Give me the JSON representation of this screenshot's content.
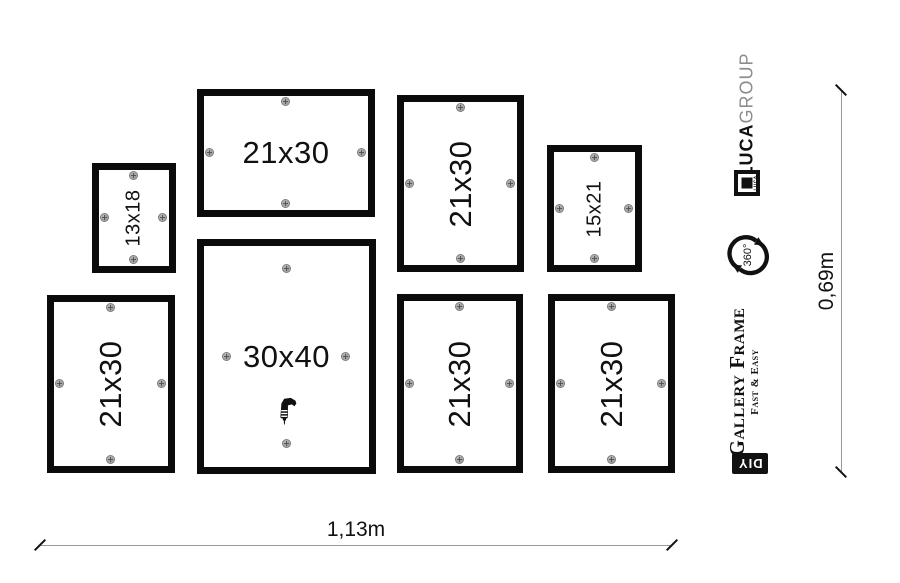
{
  "frames": [
    {
      "id": "frame-13x18-top-left",
      "label": "13x18",
      "x": 92,
      "y": 163,
      "w": 84,
      "h": 110,
      "rotated": true,
      "size": "small",
      "screw_inset": 13,
      "has_drill": false
    },
    {
      "id": "frame-21x30-top-center",
      "label": "21x30",
      "x": 197,
      "y": 89,
      "w": 178,
      "h": 128,
      "rotated": false,
      "size": "large",
      "screw_inset": 13,
      "has_drill": false
    },
    {
      "id": "frame-21x30-top-right",
      "label": "21x30",
      "x": 397,
      "y": 95,
      "w": 127,
      "h": 177,
      "rotated": true,
      "size": "large",
      "screw_inset": 13,
      "has_drill": false
    },
    {
      "id": "frame-15x21-top-far-right",
      "label": "15x21",
      "x": 547,
      "y": 145,
      "w": 95,
      "h": 127,
      "rotated": true,
      "size": "small",
      "screw_inset": 13,
      "has_drill": false
    },
    {
      "id": "frame-21x30-bottom-left",
      "label": "21x30",
      "x": 47,
      "y": 295,
      "w": 128,
      "h": 178,
      "rotated": true,
      "size": "large",
      "screw_inset": 13,
      "has_drill": false
    },
    {
      "id": "frame-30x40-center",
      "label": "30x40",
      "x": 197,
      "y": 239,
      "w": 179,
      "h": 235,
      "rotated": false,
      "size": "large",
      "screw_inset": 30,
      "has_drill": true
    },
    {
      "id": "frame-21x30-bottom-middle",
      "label": "21x30",
      "x": 397,
      "y": 294,
      "w": 126,
      "h": 179,
      "rotated": true,
      "size": "large",
      "screw_inset": 13,
      "has_drill": false
    },
    {
      "id": "frame-21x30-bottom-right",
      "label": "21x30",
      "x": 548,
      "y": 294,
      "w": 127,
      "h": 179,
      "rotated": true,
      "size": "large",
      "screw_inset": 13,
      "has_drill": false
    }
  ],
  "dimensions": {
    "width_label": "1,13m",
    "height_label": "0,69m"
  },
  "branding": {
    "company_name_bold": "LUCA",
    "company_name_light": "GROUP",
    "logo_micro_text": "LUCA",
    "rotation_badge": "360°",
    "product_name": "Gallery Frame",
    "product_tagline": "Fast & Easy",
    "diy_badge": "DIY"
  },
  "icons": {
    "screw": "phillips-screw-head",
    "drill": "power-drill",
    "rotation": "circular-arrows-360"
  },
  "colors": {
    "frame_black": "#0b0b0b",
    "screw_gray": "#8f8f8f",
    "dimension_line_gray": "#9a9a9a",
    "group_text_gray": "#8d8d8d",
    "badge_background": "#111111",
    "badge_text": "#ffffff"
  }
}
